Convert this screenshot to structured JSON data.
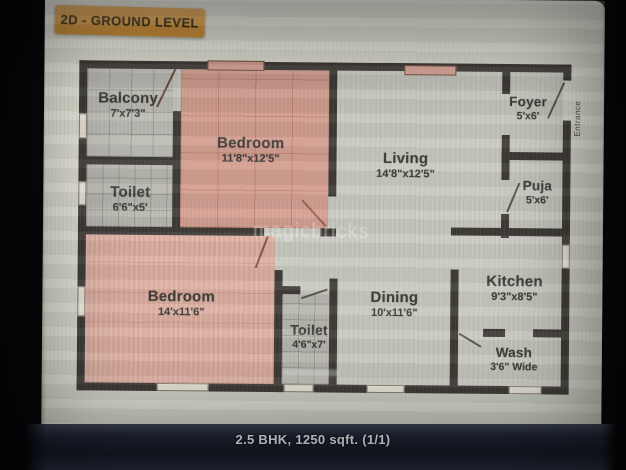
{
  "banner_title": "2D - GROUND LEVEL",
  "caption": "2.5 BHK, 1250 sqft. (1/1)",
  "watermark": "magicbricks",
  "entrance_label": "Entrance",
  "colors": {
    "banner_bg": "#dd9c41",
    "wall": "#403b37",
    "bedroom_floor": "#d5a092",
    "tile_floor": "#bfbfb8",
    "plain_floor": "#c7c9c0",
    "caption_bg": "#1d2331",
    "window_marker": "#d9a295"
  },
  "rooms": [
    {
      "id": "balcony",
      "name": "Balcony",
      "dims": "7'x7'3\""
    },
    {
      "id": "bedroom1",
      "name": "Bedroom",
      "dims": "11'8\"x12'5\""
    },
    {
      "id": "living",
      "name": "Living",
      "dims": "14'8\"x12'5\""
    },
    {
      "id": "foyer",
      "name": "Foyer",
      "dims": "5'x6'"
    },
    {
      "id": "toilet1",
      "name": "Toilet",
      "dims": "6'6\"x5'"
    },
    {
      "id": "puja",
      "name": "Puja",
      "dims": "5'x6'"
    },
    {
      "id": "bedroom2",
      "name": "Bedroom",
      "dims": "14'x11'6\""
    },
    {
      "id": "toilet2",
      "name": "Toilet",
      "dims": "4'6\"x7'"
    },
    {
      "id": "dining",
      "name": "Dining",
      "dims": "10'x11'6\""
    },
    {
      "id": "kitchen",
      "name": "Kitchen",
      "dims": "9'3\"x8'5\""
    },
    {
      "id": "wash",
      "name": "Wash",
      "dims": "3'6\" Wide"
    }
  ]
}
